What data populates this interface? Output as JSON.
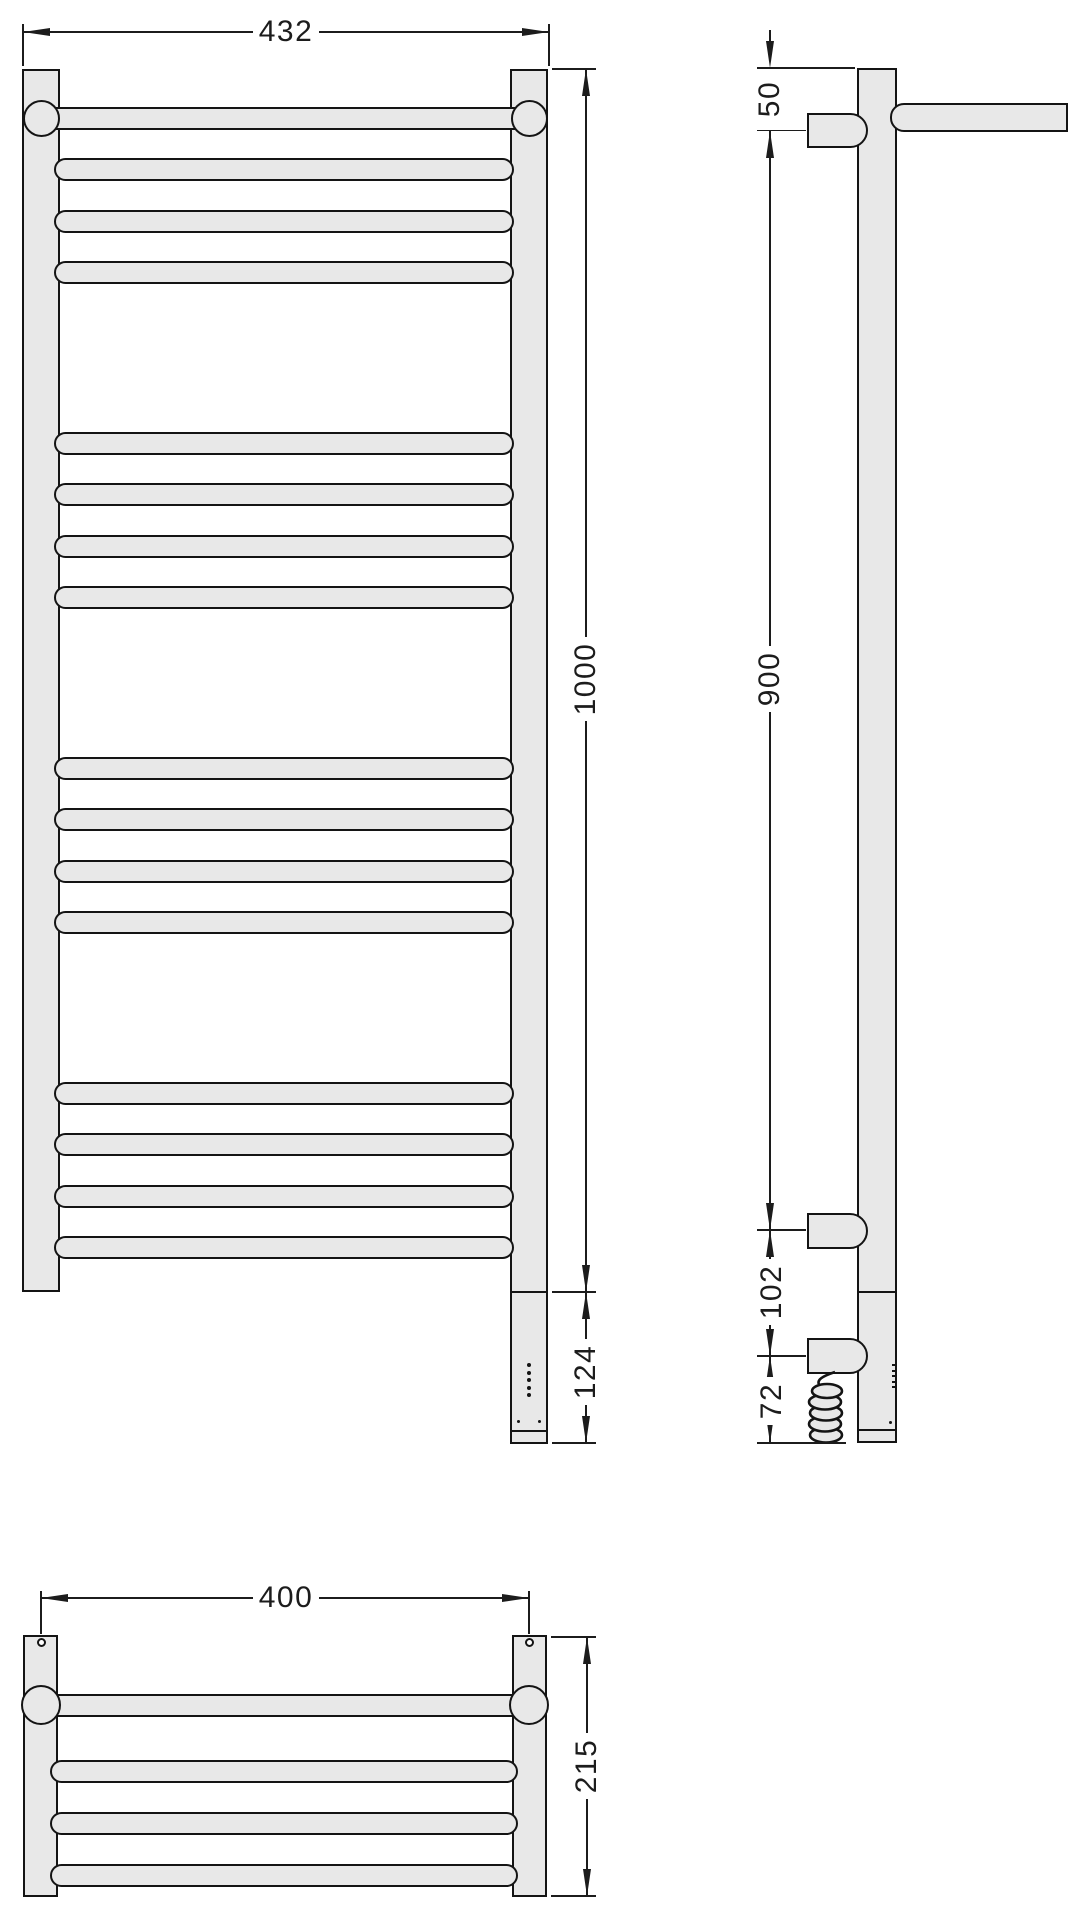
{
  "drawing": {
    "type": "technical-drawing",
    "subject": "wall-mounted heated towel rail with top shelf and electric heating element",
    "views": {
      "front": {
        "bar_groups": 4,
        "bars_per_group": 4,
        "heater_led_dots": 5
      },
      "side": {
        "wall_brackets": 2,
        "heater_bracket": 1,
        "has_coiled_cable": true
      },
      "bottom": {
        "shelf_bars": 4,
        "mounting_holes": 2
      }
    }
  },
  "dimensions": {
    "front_width": "432",
    "front_height": "1000",
    "heater_housing_height": "124",
    "side_top_to_bracket": "50",
    "side_bracket_span": "900",
    "side_bracket_to_heater": "102",
    "side_heater_to_bottom": "72",
    "bottom_hole_spacing": "400",
    "bottom_depth": "215"
  },
  "colors": {
    "outline": "#141414",
    "part_fill": "#e8e8e8",
    "dimension_ink": "#1c1c1c",
    "background": "#ffffff"
  }
}
